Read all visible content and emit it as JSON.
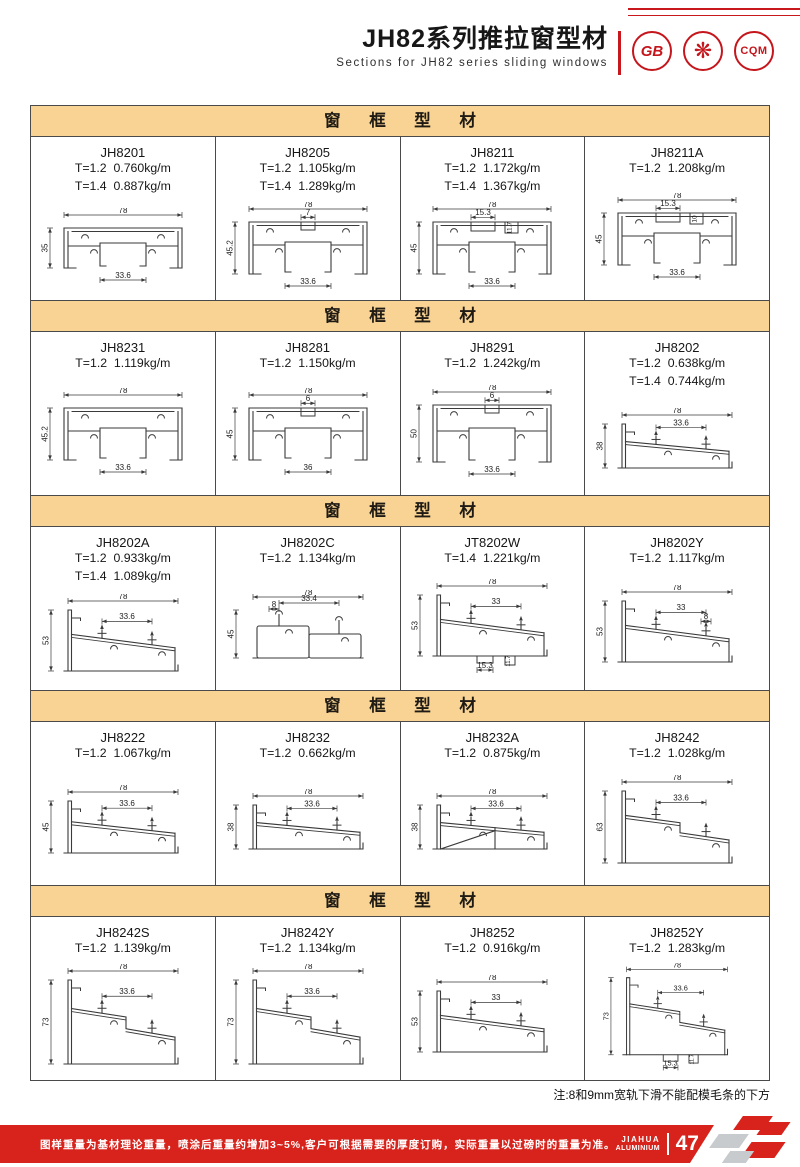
{
  "header": {
    "title": "JH82系列推拉窗型材",
    "subtitle": "Sections for JH82 series sliding windows",
    "logos": [
      {
        "name": "gb-certification-stamp",
        "text": "GB"
      },
      {
        "name": "star-certification-stamp",
        "text": "❋"
      },
      {
        "name": "cqm-certification-stamp",
        "text": "CQM"
      }
    ]
  },
  "sections": [
    {
      "title": "窗 框 型 材",
      "products": [
        {
          "code": "JH8201",
          "specs": [
            "T=1.2  0.760kg/m",
            "T=1.4  0.887kg/m"
          ],
          "draw": {
            "kind": "frame",
            "w": "78",
            "h": "35",
            "inner": "33.6",
            "hmm": 35
          }
        },
        {
          "code": "JH8205",
          "specs": [
            "T=1.2  1.105kg/m",
            "T=1.4  1.289kg/m"
          ],
          "draw": {
            "kind": "frame",
            "w": "78",
            "h": "45.2",
            "inner": "33.6",
            "notch": "7",
            "hmm": 45
          }
        },
        {
          "code": "JH8211",
          "specs": [
            "T=1.2  1.172kg/m",
            "T=1.4  1.367kg/m"
          ],
          "draw": {
            "kind": "frame",
            "w": "78",
            "h": "45",
            "inner": "33.6",
            "slotTop": "15.3",
            "slotSide": "11.7",
            "hmm": 45
          }
        },
        {
          "code": "JH8211A",
          "specs": [
            "T=1.2  1.208kg/m"
          ],
          "draw": {
            "kind": "frame",
            "w": "78",
            "h": "45",
            "inner": "33.6",
            "slotTop": "15.3",
            "slotSide": "10",
            "hmm": 45
          }
        }
      ]
    },
    {
      "title": "窗 框 型 材",
      "products": [
        {
          "code": "JH8231",
          "specs": [
            "T=1.2  1.119kg/m"
          ],
          "draw": {
            "kind": "frame",
            "w": "78",
            "h": "45.2",
            "inner": "33.6",
            "hmm": 45
          }
        },
        {
          "code": "JH8281",
          "specs": [
            "T=1.2  1.150kg/m"
          ],
          "draw": {
            "kind": "frame",
            "w": "78",
            "h": "45",
            "inner": "36",
            "notch": "6",
            "hmm": 45
          }
        },
        {
          "code": "JH8291",
          "specs": [
            "T=1.2  1.242kg/m"
          ],
          "draw": {
            "kind": "frame",
            "w": "78",
            "h": "50",
            "inner": "33.6",
            "notch": "6",
            "hmm": 50
          }
        },
        {
          "code": "JH8202",
          "specs": [
            "T=1.2  0.638kg/m",
            "T=1.4  0.744kg/m"
          ],
          "draw": {
            "kind": "sill",
            "w": "78",
            "h": "38",
            "inner": "33.6",
            "hmm": 38
          }
        }
      ]
    },
    {
      "title": "窗 框 型 材",
      "products": [
        {
          "code": "JH8202A",
          "specs": [
            "T=1.2  0.933kg/m",
            "T=1.4  1.089kg/m"
          ],
          "draw": {
            "kind": "sill",
            "w": "78",
            "h": "53",
            "inner": "33.6",
            "hmm": 53
          }
        },
        {
          "code": "JH8202C",
          "specs": [
            "T=1.2  1.134kg/m"
          ],
          "draw": {
            "kind": "boxes",
            "w": "78",
            "h": "45",
            "inner": "33.4",
            "dim8": "8",
            "hmm": 45
          }
        },
        {
          "code": "JT8202W",
          "specs": [
            "T=1.4  1.221kg/m"
          ],
          "draw": {
            "kind": "sill",
            "w": "78",
            "h": "53",
            "inner": "33",
            "bottomSlot": "15.3",
            "bottomSide": "11.7",
            "hmm": 53
          }
        },
        {
          "code": "JH8202Y",
          "specs": [
            "T=1.2  1.117kg/m"
          ],
          "draw": {
            "kind": "sill",
            "w": "78",
            "h": "53",
            "inner": "33",
            "dim8": "8",
            "hmm": 53
          }
        }
      ]
    },
    {
      "title": "窗 框 型 材",
      "products": [
        {
          "code": "JH8222",
          "specs": [
            "T=1.2  1.067kg/m"
          ],
          "draw": {
            "kind": "sill",
            "w": "78",
            "h": "45",
            "inner": "33.6",
            "hmm": 45
          }
        },
        {
          "code": "JH8232",
          "specs": [
            "T=1.2  0.662kg/m"
          ],
          "draw": {
            "kind": "sill",
            "w": "78",
            "h": "38",
            "inner": "33.6",
            "hmm": 38
          }
        },
        {
          "code": "JH8232A",
          "specs": [
            "T=1.2  0.875kg/m"
          ],
          "draw": {
            "kind": "sill",
            "w": "78",
            "h": "38",
            "inner": "33.6",
            "brace": true,
            "hmm": 38
          }
        },
        {
          "code": "JH8242",
          "specs": [
            "T=1.2  1.028kg/m"
          ],
          "draw": {
            "kind": "sill",
            "w": "78",
            "h": "63",
            "inner": "33.6",
            "step": true,
            "hmm": 63
          }
        }
      ]
    },
    {
      "title": "窗 框 型 材",
      "products": [
        {
          "code": "JH8242S",
          "specs": [
            "T=1.2  1.139kg/m"
          ],
          "draw": {
            "kind": "sill",
            "w": "78",
            "h": "73",
            "inner": "33.6",
            "step": true,
            "hmm": 73
          }
        },
        {
          "code": "JH8242Y",
          "specs": [
            "T=1.2  1.134kg/m"
          ],
          "draw": {
            "kind": "sill",
            "w": "78",
            "h": "73",
            "inner": "33.6",
            "step": true,
            "hmm": 73
          }
        },
        {
          "code": "JH8252",
          "specs": [
            "T=1.2  0.916kg/m"
          ],
          "draw": {
            "kind": "sill",
            "w": "78",
            "h": "53",
            "inner": "33",
            "hmm": 53
          }
        },
        {
          "code": "JH8252Y",
          "specs": [
            "T=1.2  1.283kg/m"
          ],
          "draw": {
            "kind": "sill",
            "w": "78",
            "h": "73",
            "inner": "33.6",
            "step": true,
            "bottomSlot": "15.3",
            "bottomSide": "11.7",
            "hmm": 73
          }
        }
      ]
    }
  ],
  "note": "注:8和9mm宽轨下滑不能配模毛条的下方",
  "footer": {
    "text": "图样重量为基材理论重量，喷涂后重量约增加3~5%,客户可根据需要的厚度订购，实际重量以过磅时的重量为准。",
    "brand_line1": "JIAHUA",
    "brand_line2": "ALUMINIUM",
    "page_number": "47"
  },
  "colors": {
    "accent_red": "#d8231c",
    "banner_bg": "#f8d394",
    "drawing_line": "#3a3a3a"
  }
}
